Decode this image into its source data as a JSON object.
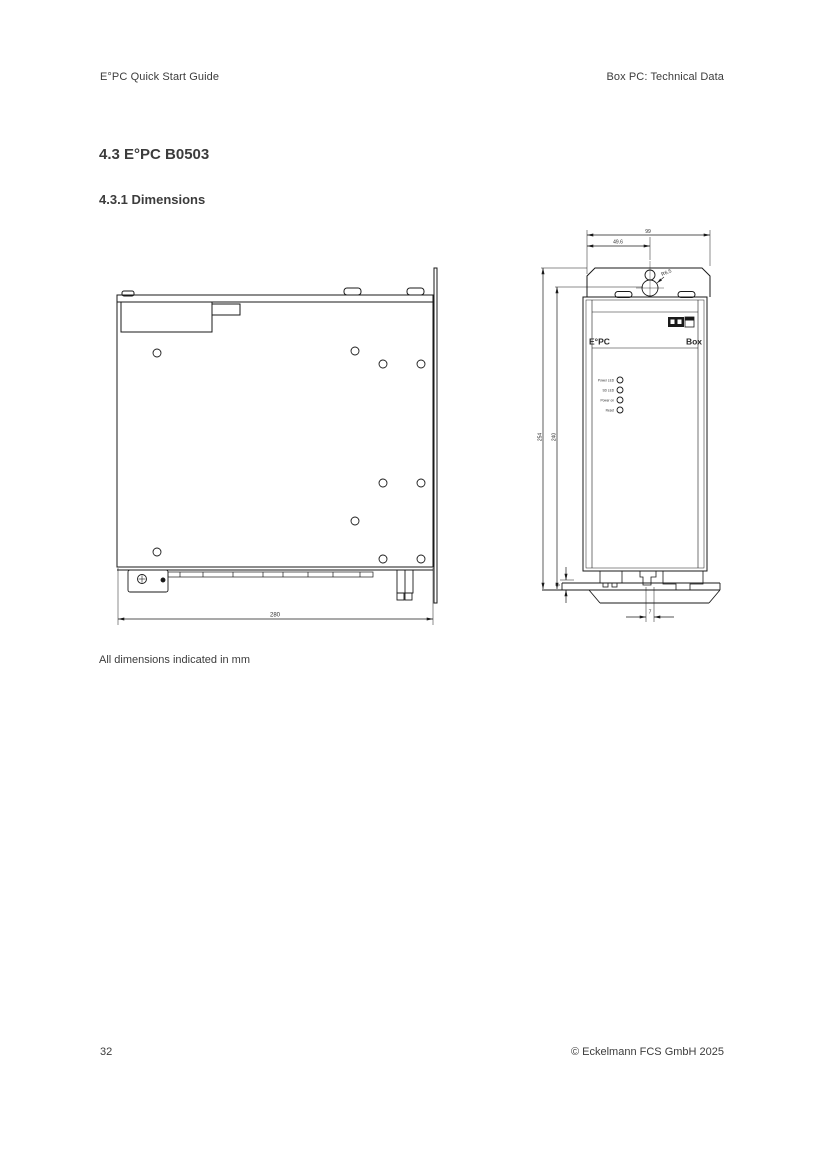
{
  "page": {
    "header": {
      "left": "E°PC Quick Start Guide",
      "right": "Box PC: Technical Data"
    },
    "section_heading": "4.3 E°PC B0503",
    "subsection_heading": "4.3.1 Dimensions",
    "figure_caption": "All dimensions indicated in mm",
    "footer": {
      "page_number": "32",
      "copyright": "© Eckelmann FCS GmbH 2025"
    }
  },
  "drawing": {
    "side_view": {
      "dim_width": "280"
    },
    "front_view": {
      "brand": "E°PC",
      "model": "Box",
      "led_labels": [
        "Power LED",
        "SD LED",
        "Power on",
        "Reset"
      ],
      "dim_width_total": "99",
      "dim_keyhole_offset": "49.6",
      "keyhole_radius_label": "R6.5",
      "dim_height_total": "254",
      "dim_height_keyhole": "240",
      "dim_bracket_offset": "8",
      "dim_tab_width": "7"
    }
  },
  "colors": {
    "page_text": "#3c3c3c",
    "drawing_line": "#1a1a1a"
  }
}
